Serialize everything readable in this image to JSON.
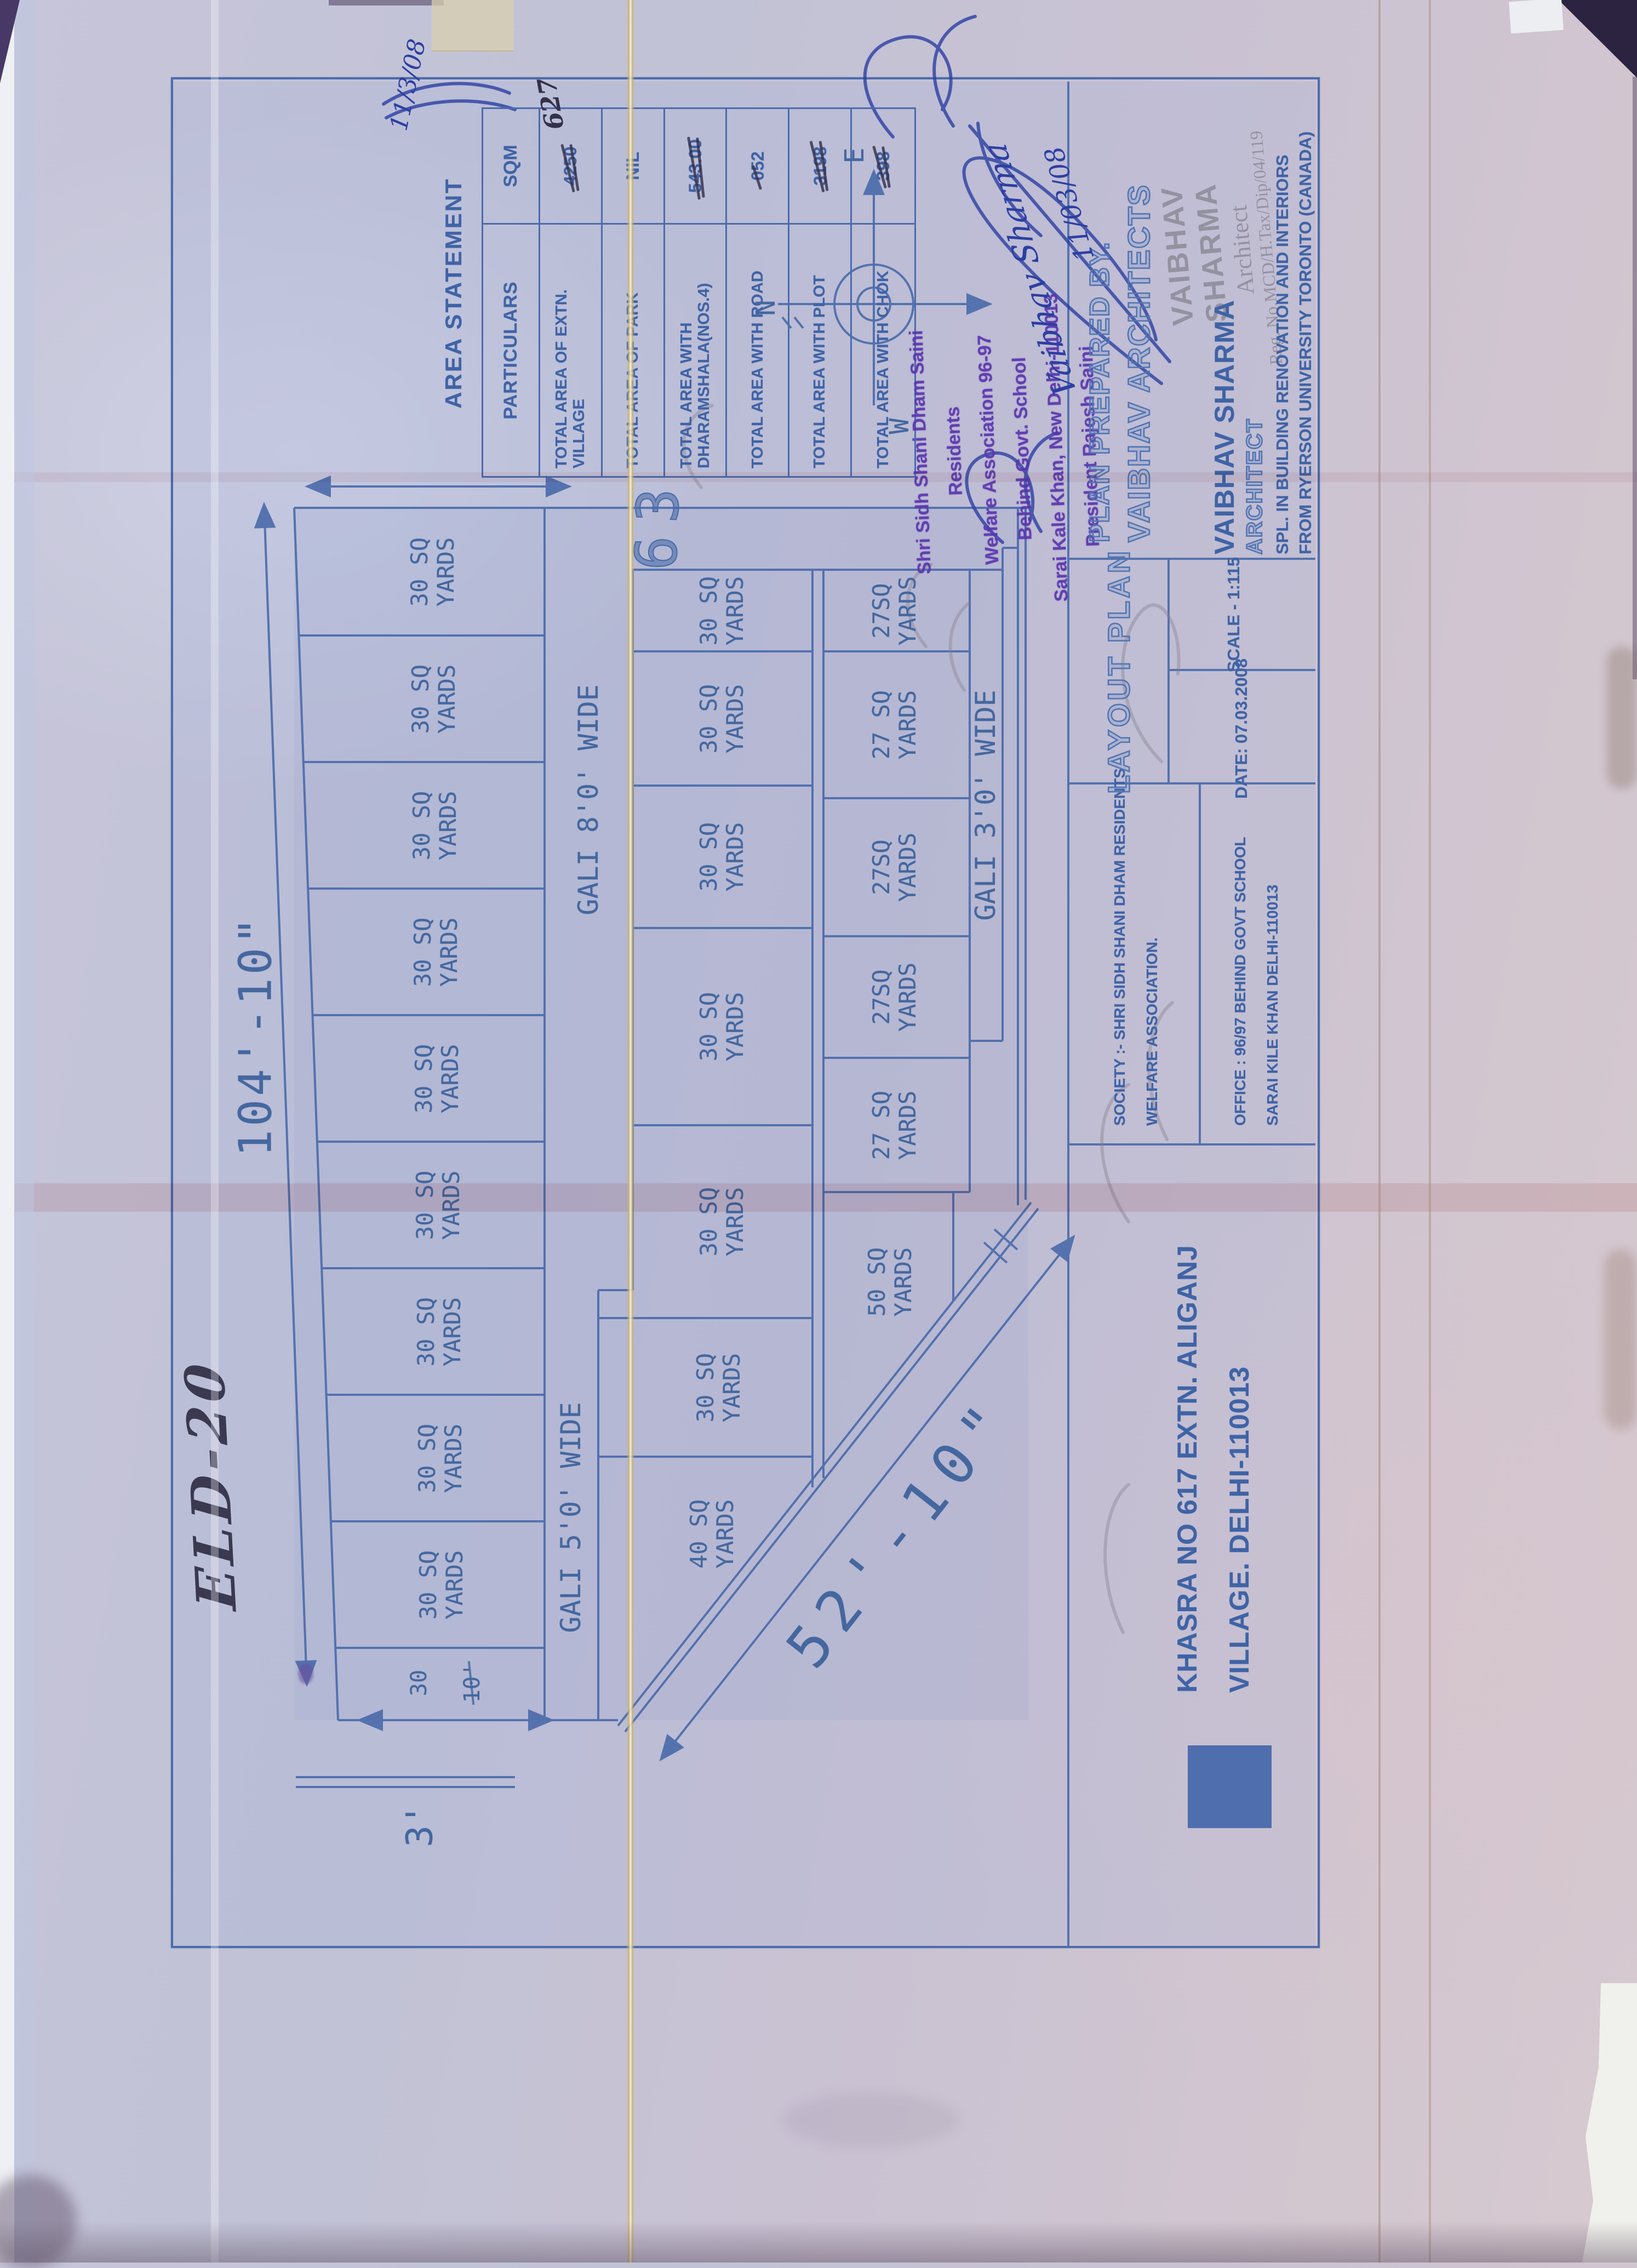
{
  "colors": {
    "blueprint_line": "#4c6cab",
    "print_text": "#3f63a6",
    "ink_blue": "#2c3fa3",
    "stamp_purple": "#5b35ae",
    "stamp_gray": "#8d8b99",
    "pen_dark": "#33304a",
    "fold_yellow": "#cbb268"
  },
  "area_statement": {
    "title": "AREA STATEMENT",
    "col_particulars": "PARTICULARS",
    "col_sqm": "SQM",
    "rows": [
      {
        "particulars": "TOTAL AREA OF EXTN. VILLAGE",
        "sqm": "4250",
        "handwritten": "627"
      },
      {
        "particulars": "TOTAL AREA OF PARK",
        "sqm": "NIL"
      },
      {
        "particulars": "TOTAL AREA WITH DHARAMSHALA(NOS.4)",
        "sqm": "543.00"
      },
      {
        "particulars": "TOTAL AREA WITH ROAD",
        "sqm": "052"
      },
      {
        "particulars": "TOTAL AREA WITH PLOT",
        "sqm": "3198"
      },
      {
        "particulars": "TOTAL AREA WITH CHOK",
        "sqm": "398"
      }
    ]
  },
  "compass": {
    "north": "N",
    "east": "E",
    "west": "W"
  },
  "plan": {
    "dim_width": "104'-10\"",
    "dim_diagonal": "52'-10\"",
    "dim_side": "3'",
    "corner_strip": {
      "area": "30",
      "length": "10'"
    },
    "plot_number": "63",
    "street_top_right": "GALI 8'0' WIDE",
    "street_top_left": "GALI 5'0' WIDE",
    "street_bottom": "GALI 3'0' WIDE",
    "row_a": [
      "30 SQ YARDS",
      "30 SQ YARDS",
      "30 SQ YARDS",
      "30 SQ YARDS",
      "30 SQ YARDS",
      "30 SQ YARDS",
      "30 SQ YARDS",
      "30 SQ YARDS",
      "30 SQ YARDS"
    ],
    "row_b": [
      "40 SQ YARDS",
      "30 SQ YARDS",
      "30 SQ YARDS",
      "30 SQ YARDS",
      "30 SQ YARDS",
      "30 SQ YARDS",
      "30 SQ YARDS"
    ],
    "row_c": [
      "50 SQ YARDS",
      "27 SQ YARDS",
      "27SQ YARDS",
      "27SQ YARDS",
      "27 SQ YARDS",
      "27SQ YARDS"
    ]
  },
  "handwriting": {
    "site_code": "ELD-20",
    "sig_name": "Vaibhav Sharma",
    "sig_date": "11/03/08",
    "corner_date": "11/3/08"
  },
  "stamp_purple": {
    "lines": [
      "Shri Sidh Shani Dham Saini Residents",
      "Welfare Association 96-97",
      "Behind Govt. School",
      "Sarai Kale Khan, New Delhi-110013",
      "President Rajesh Saini"
    ]
  },
  "title_block": {
    "khasra_line1": "KHASRA NO 617 EXTN. ALIGANJ",
    "khasra_line2": "VILLAGE. DELHI-110013",
    "society_line1": "SOCIETY :- SHRI SIDH SHANI DHAM RESIDENTS",
    "society_line2": "WELFARE ASSOCIATION.",
    "office_line1": "OFFICE : 96/97 BEHIND GOVT SCHOOL",
    "office_line2": "SARAI KILE KHAN DELHI-110013",
    "drawing_title": "LAYOUT PLAN",
    "date": "DATE: 07.03.2008",
    "scale": "SCALE - 1:115",
    "prepared_line1": "PLAN PREPARED BY.",
    "prepared_line2": "VAIBHAV ARCHITECTS",
    "architect_name": "VAIBHAV SHARMA",
    "architect_title": "ARCHITECT",
    "architect_line3": "SPL. IN BUILDING RENOVATION AND INTERIORS",
    "architect_line4": "FROM RYERSON UNIVERSITY TORONTO (CANADA)",
    "stamp_name": "VAIBHAV SHARMA",
    "stamp_title": "Architect",
    "stamp_reg": "Reg. No.MCD/H.Tax/Dip/04/119"
  }
}
